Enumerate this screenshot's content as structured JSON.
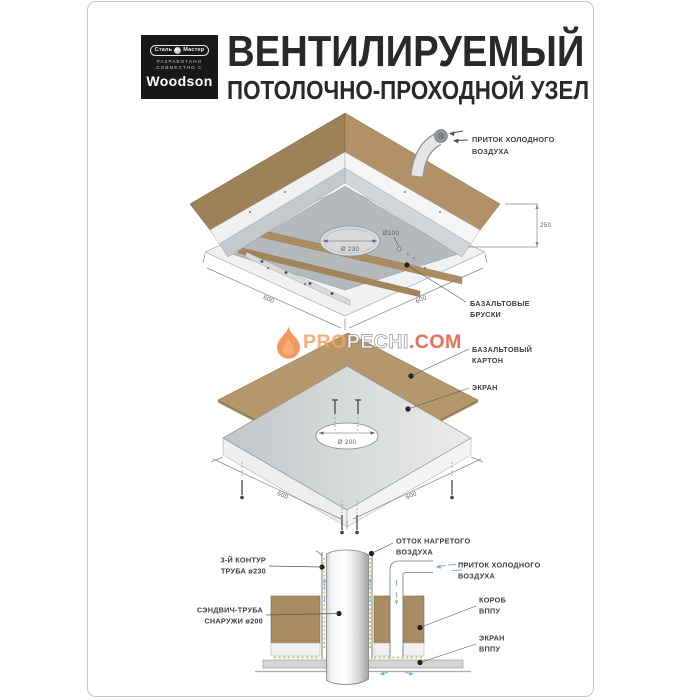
{
  "page": {
    "bg": "#ffffff",
    "border_color": "#c6c6c6"
  },
  "colors": {
    "wood_dark": "#9d8157",
    "wood_light": "#b29166",
    "wood_board": "#b4986c",
    "metal_plate": "#b6b9bb",
    "metal_light": "#eef0f1",
    "accent_flame": "#ef8544",
    "watermark_red": "#e64e32",
    "air_blue": "#7db0d2",
    "insulation_yellow": "#d2b766"
  },
  "header": {
    "logo": {
      "badge_left": "Сталь",
      "badge_right": "Мастер",
      "sub_1": "РАЗРАБОТАНО",
      "sub_2": "СОВМЕСТНО С",
      "brand": "Woodson"
    },
    "title_line1": "ВЕНТИЛИРУЕМЫЙ",
    "title_line2": "ПОТОЛОЧНО-ПРОХОДНОЙ УЗЕЛ"
  },
  "watermark": {
    "pro": "PRO",
    "pechi": "PECHI",
    "com": ".COM"
  },
  "top": {
    "cold_air_1": "ПРИТОК ХОЛОДНОГО",
    "cold_air_2": "ВОЗДУХА",
    "dim_height": "250",
    "dim_left": "600",
    "dim_right": "600",
    "hole_large": "Ø 230",
    "hole_small": "Ø100",
    "bars_1": "БАЗАЛЬТОВЫЕ",
    "bars_2": "БРУСКИ"
  },
  "middle": {
    "board_1": "БАЗАЛЬТОВЫЙ",
    "board_2": "КАРТОН",
    "screen": "ЭКРАН",
    "hole": "Ø 200",
    "dim_left": "600",
    "dim_right": "600"
  },
  "bottom": {
    "contour_1": "3-Й КОНТУР",
    "contour_2": "ТРУБА ø230",
    "sandwich_1": "СЭНДВИЧ-ТРУБА",
    "sandwich_2": "СНАРУЖИ ø200",
    "hot_1": "ОТТОК НАГРЕТОГО",
    "hot_2": "ВОЗДУХА",
    "cold_1": "ПРИТОК ХОЛОДНОГО",
    "cold_2": "ВОЗДУХА",
    "box_1": "КОРОБ",
    "box_2": "ВППУ",
    "screen_1": "ЭКРАН",
    "screen_2": "ВППУ"
  }
}
